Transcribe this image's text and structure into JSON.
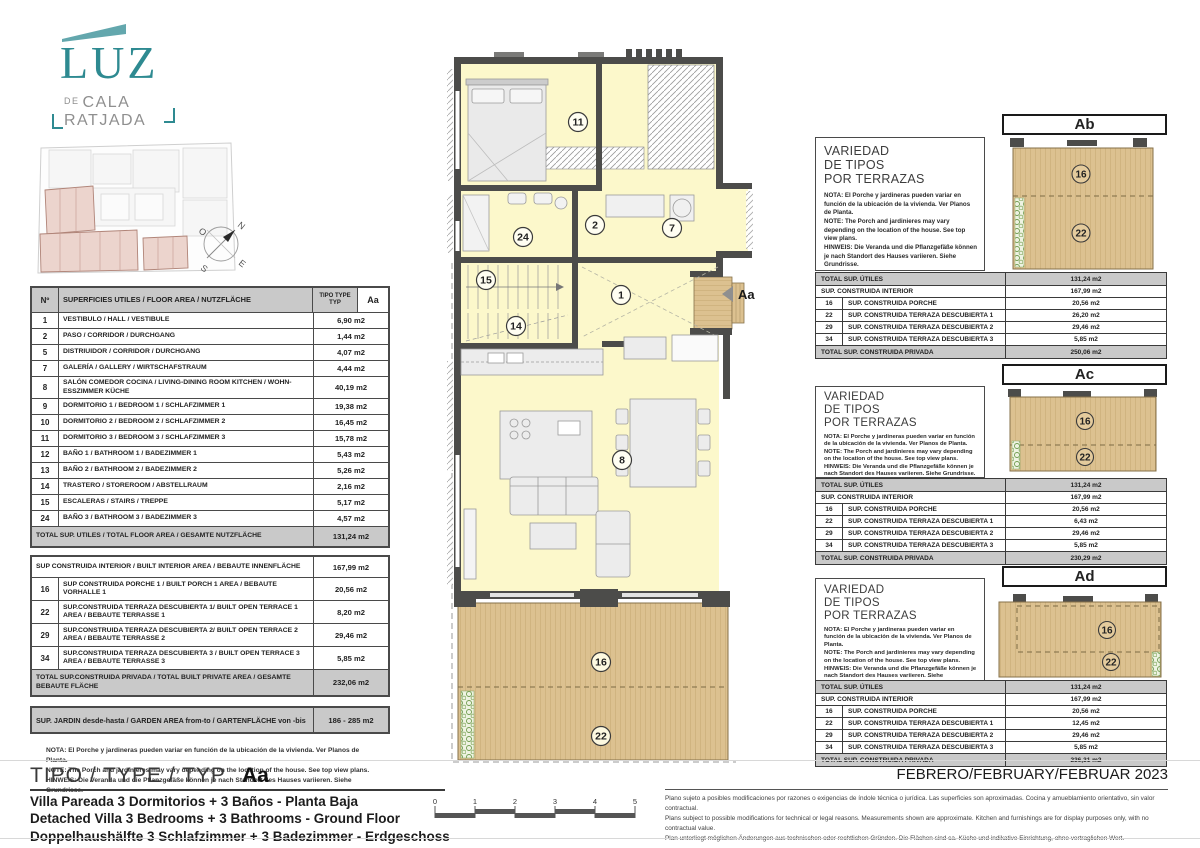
{
  "logo": {
    "title": "LUZ",
    "de": "DE",
    "line1": "CALA",
    "line2": "RATJADA"
  },
  "compass": {
    "n": "N",
    "s": "S",
    "e": "E",
    "o": "O"
  },
  "colors": {
    "accent": "#2e8a91",
    "wall": "#4c4c4a",
    "room_yellow": "#fcf8cb",
    "deck_tan": "#d9bd8c",
    "site_pink": "#ecd4cd",
    "table_gray": "#c9c9c9"
  },
  "area_table": {
    "header": {
      "num": "Nº",
      "desc": "SUPERFICIES UTILES / FLOOR AREA / NUTZFLÄCHE",
      "tipo": "TIPO TYPE TYP",
      "type_code": "Aa"
    },
    "rows": [
      {
        "num": "1",
        "desc": "VESTIBULO / HALL  / VESTIBULE",
        "value": "6,90 m2"
      },
      {
        "num": "2",
        "desc": "PASO  / CORRIDOR  / DURCHGANG",
        "value": "1,44 m2"
      },
      {
        "num": "5",
        "desc": "DISTRIUIDOR  / CORRIDOR  / DURCHGANG",
        "value": "4,07 m2"
      },
      {
        "num": "7",
        "desc": "GALERÍA / GALLERY / WIRTSCHAFSTRAUM",
        "value": "4,44 m2"
      },
      {
        "num": "8",
        "desc": "SALÓN COMEDOR COCINA / LIVING-DINING ROOM KITCHEN / WOHN-ESSZIMMER  KÜCHE",
        "value": "40,19 m2"
      },
      {
        "num": "9",
        "desc": "DORMITORIO 1 / BEDROOM 1 / SCHLAFZIMMER 1",
        "value": "19,38 m2"
      },
      {
        "num": "10",
        "desc": "DORMITORIO 2 / BEDROOM 2 / SCHLAFZIMMER 2",
        "value": "16,45 m2"
      },
      {
        "num": "11",
        "desc": "DORMITORIO 3 / BEDROOM 3 / SCHLAFZIMMER 3",
        "value": "15,78 m2"
      },
      {
        "num": "12",
        "desc": "BAÑO 1 / BATHROOM 1 / BADEZIMMER 1",
        "value": "5,43 m2"
      },
      {
        "num": "13",
        "desc": "BAÑO 2 / BATHROOM 2  / BADEZIMMER 2",
        "value": "5,26 m2"
      },
      {
        "num": "14",
        "desc": "TRASTERO / STOREROOM / ABSTELLRAUM",
        "value": "2,16 m2"
      },
      {
        "num": "15",
        "desc": "ESCALERAS / STAIRS / TREPPE",
        "value": "5,17 m2"
      },
      {
        "num": "24",
        "desc": "BAÑO 3 / BATHROOM 3 / BADEZIMMER 3",
        "value": "4,57 m2"
      }
    ],
    "total_utiles": {
      "desc": "TOTAL SUP. UTILES / TOTAL FLOOR AREA / GESAMTE NUTZFLÄCHE",
      "value": "131,24 m2"
    },
    "interior": {
      "desc": "SUP CONSTRUIDA INTERIOR / BUILT INTERIOR AREA / BEBAUTE INNENFLÄCHE",
      "value": "167,99 m2"
    },
    "built_rows": [
      {
        "num": "16",
        "desc": "SUP CONSTRUIDA PORCHE 1 / BUILT PORCH 1 AREA / BEBAUTE VORHALLE 1",
        "value": "20,56 m2"
      },
      {
        "num": "22",
        "desc": "SUP.CONSTRUIDA TERRAZA DESCUBIERTA 1/ BUILT OPEN TERRACE  1 AREA / BEBAUTE TERRASSE 1",
        "value": "8,20 m2"
      },
      {
        "num": "29",
        "desc": "SUP.CONSTRUIDA TERRAZA DESCUBIERTA 2/ BUILT OPEN TERRACE 2 AREA / BEBAUTE TERRASSE 2",
        "value": "29,46 m2"
      },
      {
        "num": "34",
        "desc": "SUP.CONSTRUIDA TERRAZA DESCUBIERTA 3 / BUILT OPEN TERRACE 3 AREA / BEBAUTE TERRASSE 3",
        "value": "5,85 m2"
      }
    ],
    "total_privada": {
      "desc": "TOTAL SUP.CONSTRUIDA PRIVADA / TOTAL  BUILT PRIVATE AREA / GESAMTE BEBAUTE FLÄCHE",
      "value": "232,06 m2"
    },
    "jardin": {
      "desc": "SUP. JARDIN desde-hasta / GARDEN AREA from-to / GARTENFLÄCHE von -bis",
      "value": "186 - 285 m2"
    },
    "nota": [
      "NOTA: El Porche y jardineras pueden variar en función de la ubicación de la vivienda. Ver Planos de Planta.",
      "NOTE: The Porch and jardinieres may vary depending on the location of the house. See top view plans.",
      "HINWEIS: Die Veranda und die Pflanzgefäße können je nach Standort des Hauses variieren. Siehe Grundrisse."
    ]
  },
  "plan": {
    "labels": {
      "n1": "1",
      "n2": "2",
      "n7": "7",
      "n8": "8",
      "n11": "11",
      "n14": "14",
      "n15": "15",
      "n16": "16",
      "n22": "22",
      "n24": "24"
    },
    "marker": "Aa"
  },
  "variants": [
    {
      "code": "Ab",
      "title": [
        "VARIEDAD",
        "DE TIPOS",
        "POR TERRAZAS"
      ],
      "nota_es": "NOTA: El Porche y jardineras pueden variar en función de la ubicación de la vivienda. Ver Planos de Planta.",
      "nota_en": "NOTE: The Porch and jardinieres may vary depending on the location of the house. See top view plans.",
      "nota_de": "HINWEIS: Die Veranda und die Pflanzgefäße können je nach Standort des Hauses variieren. Siehe Grundrisse.",
      "thumb_labels": [
        "16",
        "22"
      ],
      "rows": [
        {
          "num": "",
          "label": "TOTAL SUP. ÚTILES",
          "value": "131,24 m2"
        },
        {
          "num": "",
          "label": "SUP. CONSTRUIDA INTERIOR",
          "value": "167,99 m2"
        },
        {
          "num": "16",
          "label": "SUP. CONSTRUIDA PORCHE",
          "value": "20,56 m2"
        },
        {
          "num": "22",
          "label": "SUP. CONSTRUIDA TERRAZA DESCUBIERTA 1",
          "value": "26,20 m2"
        },
        {
          "num": "29",
          "label": "SUP. CONSTRUIDA TERRAZA DESCUBIERTA 2",
          "value": "29,46 m2"
        },
        {
          "num": "34",
          "label": "SUP. CONSTRUIDA TERRAZA DESCUBIERTA 3",
          "value": "5,85 m2"
        },
        {
          "num": "",
          "label": "TOTAL SUP. CONSTRUIDA PRIVADA",
          "value": "250,06 m2"
        }
      ]
    },
    {
      "code": "Ac",
      "title": [
        "VARIEDAD",
        "DE TIPOS",
        "POR TERRAZAS"
      ],
      "nota_es": "NOTA: El Porche y jardineras pueden variar en función de la ubicación de la vivienda. Ver Planos de Planta.",
      "nota_en": "NOTE: The Porch and jardinieres may vary depending on the location of the house. See top view plans.",
      "nota_de": "HINWEIS: Die Veranda und die Pflanzgefäße können je nach Standort des Hauses variieren. Siehe Grundrisse.",
      "thumb_labels": [
        "16",
        "22"
      ],
      "rows": [
        {
          "num": "",
          "label": "TOTAL SUP. ÚTILES",
          "value": "131,24 m2"
        },
        {
          "num": "",
          "label": "SUP. CONSTRUIDA INTERIOR",
          "value": "167,99 m2"
        },
        {
          "num": "16",
          "label": "SUP. CONSTRUIDA PORCHE",
          "value": "20,56 m2"
        },
        {
          "num": "22",
          "label": "SUP. CONSTRUIDA TERRAZA DESCUBIERTA 1",
          "value": "6,43 m2"
        },
        {
          "num": "29",
          "label": "SUP. CONSTRUIDA TERRAZA DESCUBIERTA 2",
          "value": "29,46 m2"
        },
        {
          "num": "34",
          "label": "SUP. CONSTRUIDA TERRAZA DESCUBIERTA 3",
          "value": "5,85 m2"
        },
        {
          "num": "",
          "label": "TOTAL SUP. CONSTRUIDA PRIVADA",
          "value": "230,29 m2"
        }
      ]
    },
    {
      "code": "Ad",
      "title": [
        "VARIEDAD",
        "DE TIPOS",
        "POR TERRAZAS"
      ],
      "nota_es": "NOTA: El Porche y jardineras pueden variar en función de la ubicación de la vivienda. Ver Planos de Planta.",
      "nota_en": "NOTE: The Porch and jardinieres may vary depending on the location of the house. See top view plans.",
      "nota_de": "HINWEIS: Die Veranda und die Pflanzgefäße können je nach Standort des Hauses variieren. Siehe Grundrisse.",
      "thumb_labels": [
        "16",
        "22"
      ],
      "rows": [
        {
          "num": "",
          "label": "TOTAL SUP. ÚTILES",
          "value": "131,24 m2"
        },
        {
          "num": "",
          "label": "SUP. CONSTRUIDA INTERIOR",
          "value": "167,99 m2"
        },
        {
          "num": "16",
          "label": "SUP. CONSTRUIDA PORCHE",
          "value": "20,56 m2"
        },
        {
          "num": "22",
          "label": "SUP. CONSTRUIDA TERRAZA DESCUBIERTA 1",
          "value": "12,45 m2"
        },
        {
          "num": "29",
          "label": "SUP. CONSTRUIDA TERRAZA DESCUBIERTA 2",
          "value": "29,46 m2"
        },
        {
          "num": "34",
          "label": "SUP. CONSTRUIDA TERRAZA DESCUBIERTA 3",
          "value": "5,85 m2"
        },
        {
          "num": "",
          "label": "TOTAL SUP. CONSTRUIDA PRIVADA",
          "value": "236,31 m2"
        }
      ]
    }
  ],
  "footer": {
    "tipo_label": "TIPO / TYPE / TYP",
    "tipo_code": "Aa",
    "desc_es": "Villa Pareada 3 Dormitorios + 3 Baños - Planta Baja",
    "desc_en": "Detached Villa 3 Bedrooms + 3 Bathrooms - Ground Floor",
    "desc_de": "Doppelhaushälfte 3 Schlafzimmer + 3 Badezimmer - Erdgeschoss",
    "date": "FEBRERO/FEBRUARY/FEBRUAR 2023",
    "scale_ticks": [
      "0",
      "1",
      "2",
      "3",
      "4",
      "5"
    ],
    "legal_es": "Plano sujeto a posibles modificaciones por razones o exigencias de índole técnica o jurídica. Las superficies son aproximadas. Cocina y amueblamiento orientativo, sin valor contractual.",
    "legal_en": "Plans subject to possible modifications for technical or legal reasons. Measurements shown are approximate. Kitchen and furnishings are for display purposes only, with no contractual value.",
    "legal_de": "Plan unterliegt möglichen Änderungen aus technischen oder rechtlichen Gründen. Die Flächen sind ca. Küche und indikative Einrichtung, ohne vertraglichen Wert."
  }
}
